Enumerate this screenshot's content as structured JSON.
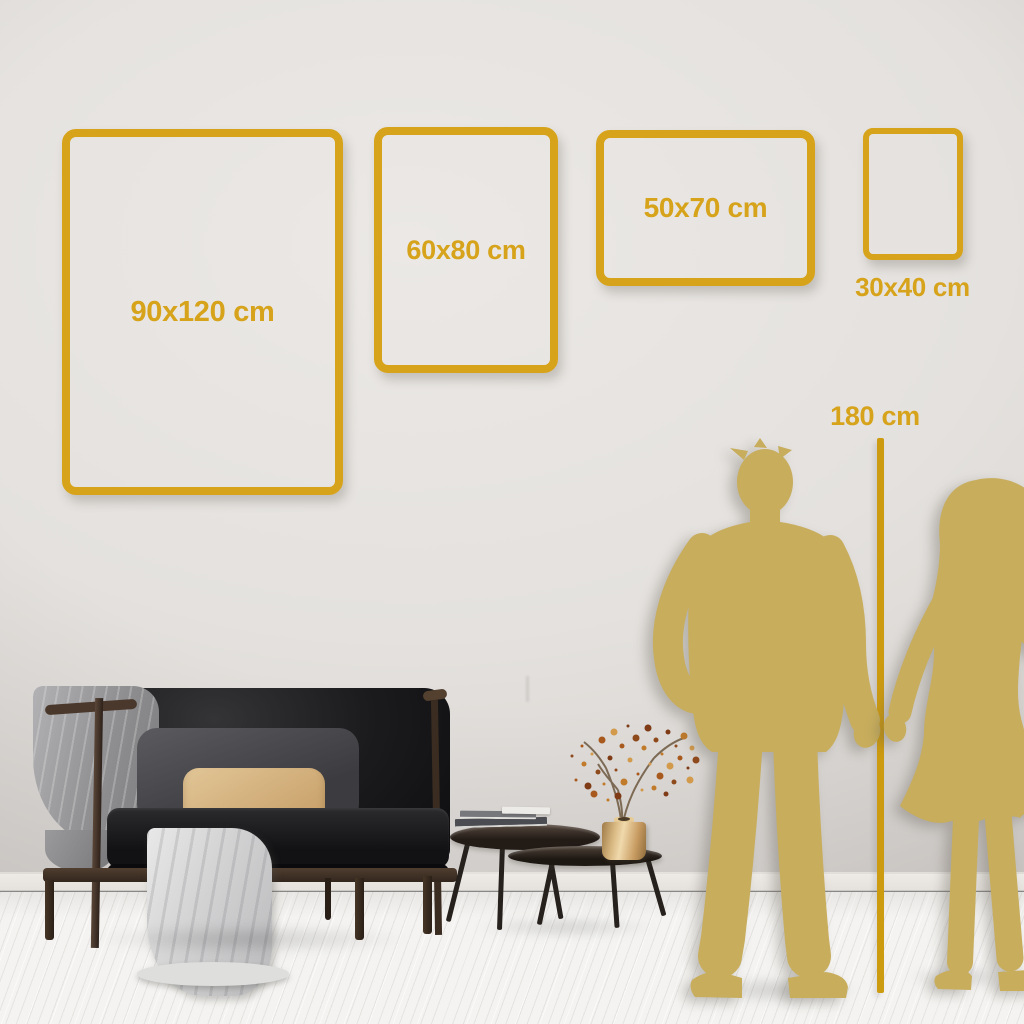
{
  "size_guide": {
    "frames": [
      {
        "label": "90x120 cm",
        "width_cm": 90,
        "height_cm": 120
      },
      {
        "label": "60x80 cm",
        "width_cm": 60,
        "height_cm": 80
      },
      {
        "label": "50x70 cm",
        "width_cm": 50,
        "height_cm": 70
      },
      {
        "label": "30x40 cm",
        "width_cm": 30,
        "height_cm": 40
      }
    ],
    "height_reference": {
      "label": "180 cm",
      "height_cm": 180
    }
  },
  "colors": {
    "frame_gold": "#D6A31B",
    "text_gold": "#D6A31B",
    "ruler_gold": "#CD9B10",
    "silhouette_gold": "#C7AD5C",
    "wall": "#E4E1DE",
    "floor": "#F4F3F1"
  },
  "scene": {
    "people": [
      "man-silhouette",
      "woman-silhouette"
    ],
    "furniture": [
      "sofa-with-throw-blankets",
      "nesting-coffee-tables",
      "stacked-books",
      "brass-vase-with-dried-branch"
    ]
  }
}
